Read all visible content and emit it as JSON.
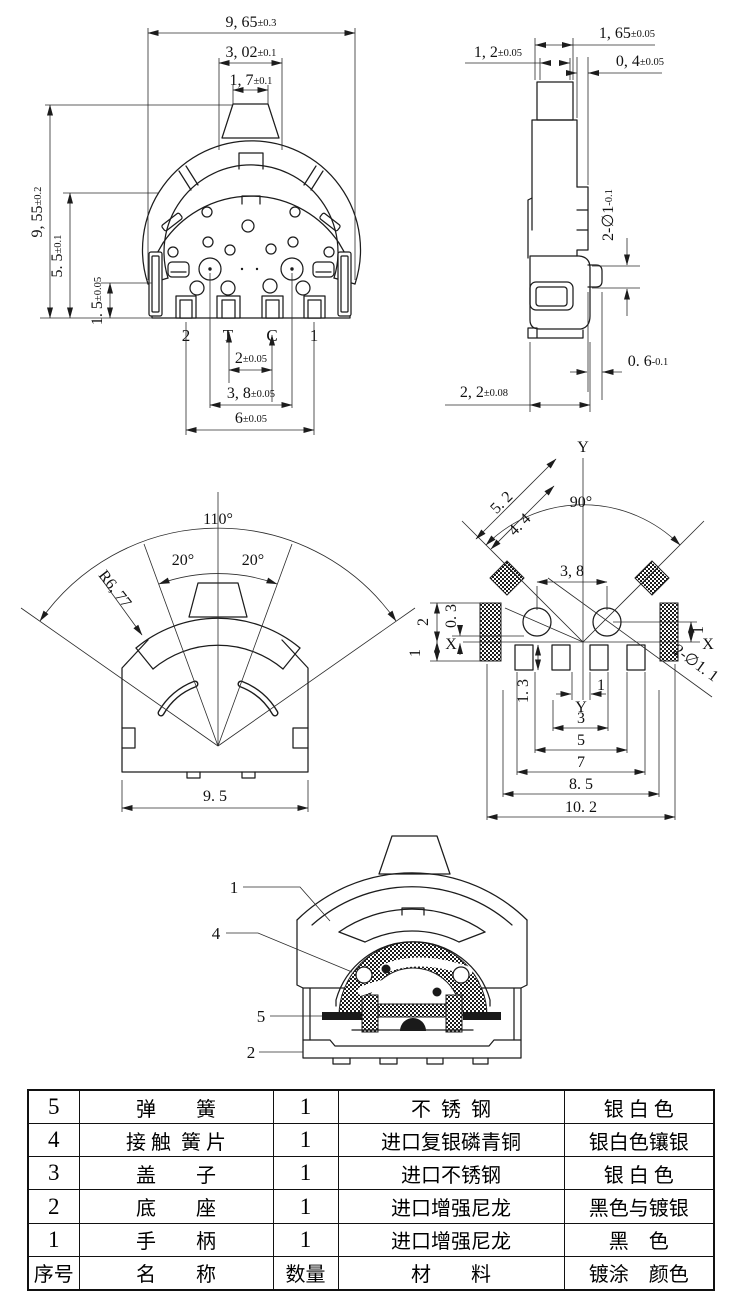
{
  "front": {
    "w_outer": {
      "v": "9, 65",
      "t": "±0.3"
    },
    "w_cap": {
      "v": "3, 02",
      "t": "±0.1"
    },
    "w_tip": {
      "v": "1, 7",
      "t": "±0.1"
    },
    "h_total": {
      "v": "9, 55",
      "t": "±0.2"
    },
    "h_body": {
      "v": "5. 5",
      "t": "±0.1"
    },
    "h_foot": {
      "v": "1. 5",
      "t": "±0.05"
    },
    "pitch": {
      "v": "2",
      "t": "±0.05"
    },
    "span_rivets": {
      "v": "3, 8",
      "t": "±0.05"
    },
    "span_pins": {
      "v": "6",
      "t": "±0.05"
    },
    "pins": [
      "2",
      "T",
      "C",
      "1"
    ]
  },
  "side": {
    "w_head": {
      "v": "1, 65",
      "t": "±0.05"
    },
    "w_stem": {
      "v": "1, 2",
      "t": "±0.05"
    },
    "w_plate": {
      "v": "0, 4",
      "t": "±0.05"
    },
    "holes": {
      "v": "2-∅1",
      "t": "-0.1"
    },
    "w_pin": {
      "v": "0. 6",
      "t": "-0.1"
    },
    "w_base": {
      "v": "2, 2",
      "t": "±0.08"
    }
  },
  "fan": {
    "a_total": "110°",
    "a_left": "20°",
    "a_right": "20°",
    "radius": "R6, 77",
    "width": "9. 5"
  },
  "rot": {
    "y1": "Y",
    "y2": "Y",
    "xl": "X",
    "xr": "X",
    "d52": "5. 2",
    "d44": "4. 4",
    "a90": "90°",
    "d38": "3, 8",
    "l2": "2",
    "l03": "0. 3",
    "l1": "1",
    "r1": "1",
    "holes": "2-∅1. 1",
    "padh": "1. 3",
    "gap": "1",
    "s3": "3",
    "s5": "5",
    "s7": "7",
    "s85": "8. 5",
    "s102": "10. 2"
  },
  "sec": {
    "c1": "1",
    "c4": "4",
    "c5": "5",
    "c2": "2"
  },
  "table": {
    "header": {
      "no": "序号",
      "name": "名        称",
      "qty": "数量",
      "mat": "材        料",
      "fin": "镀涂    颜色"
    },
    "rows": [
      {
        "no": "5",
        "name": "弹        簧",
        "qty": "1",
        "mat": "不  锈  钢",
        "fin": "银 白 色"
      },
      {
        "no": "4",
        "name": "接 触  簧 片",
        "qty": "1",
        "mat": "进口复银磷青铜",
        "fin": "银白色镶银"
      },
      {
        "no": "3",
        "name": "盖        子",
        "qty": "1",
        "mat": "进口不锈钢",
        "fin": "银 白 色"
      },
      {
        "no": "2",
        "name": "底        座",
        "qty": "1",
        "mat": "进口增强尼龙",
        "fin": "黑色与镀银"
      },
      {
        "no": "1",
        "name": "手        柄",
        "qty": "1",
        "mat": "进口增强尼龙",
        "fin": "黑    色"
      }
    ]
  }
}
